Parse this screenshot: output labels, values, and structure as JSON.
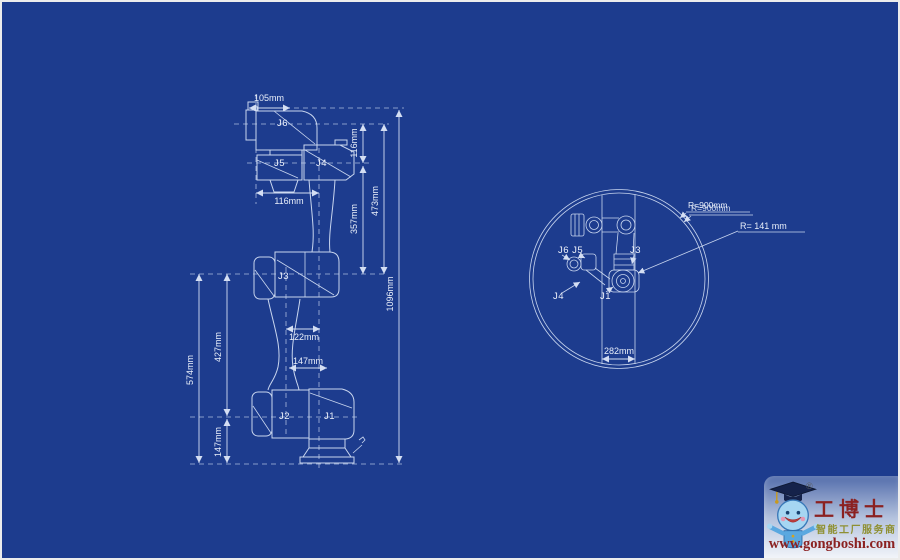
{
  "canvas": {
    "background": "#1d3c8e",
    "line_color": "#c9d6ef",
    "text_color": "#e9effa",
    "border_color": "#ececec"
  },
  "side_view": {
    "joints": {
      "j6": "J6",
      "j5": "J5",
      "j4": "J4",
      "j3": "J3",
      "j2": "J2",
      "j1": "J1"
    },
    "dims": {
      "flange_width": "105mm",
      "wrist_drop": "116mm",
      "upper_arm_length": "357mm",
      "wrist_to_elbow": "473mm",
      "total_height": "1096mm",
      "elbow_to_base": "574mm",
      "lower_arm_length": "427mm",
      "base_height": "147mm",
      "wrist_width": "116mm",
      "elbow_offset": "122mm",
      "base_offset": "147mm"
    }
  },
  "top_view": {
    "joints": {
      "j6_j5": "J6 J5",
      "j4": "J4",
      "j1": "J1",
      "j3": "J3"
    },
    "outer_radius_label": "R=900mm",
    "outer_radius_label_duplicate": "R=900mm",
    "inner_radius_label": "R= 141 mm",
    "inner_diameter": "282mm"
  },
  "logo": {
    "registered_mark": "®",
    "brand": "工博士",
    "tagline": "智能工厂服务商",
    "url": "www.gongboshi.com",
    "brand_color": "#8b2121",
    "tagline_color": "#8f9032"
  }
}
